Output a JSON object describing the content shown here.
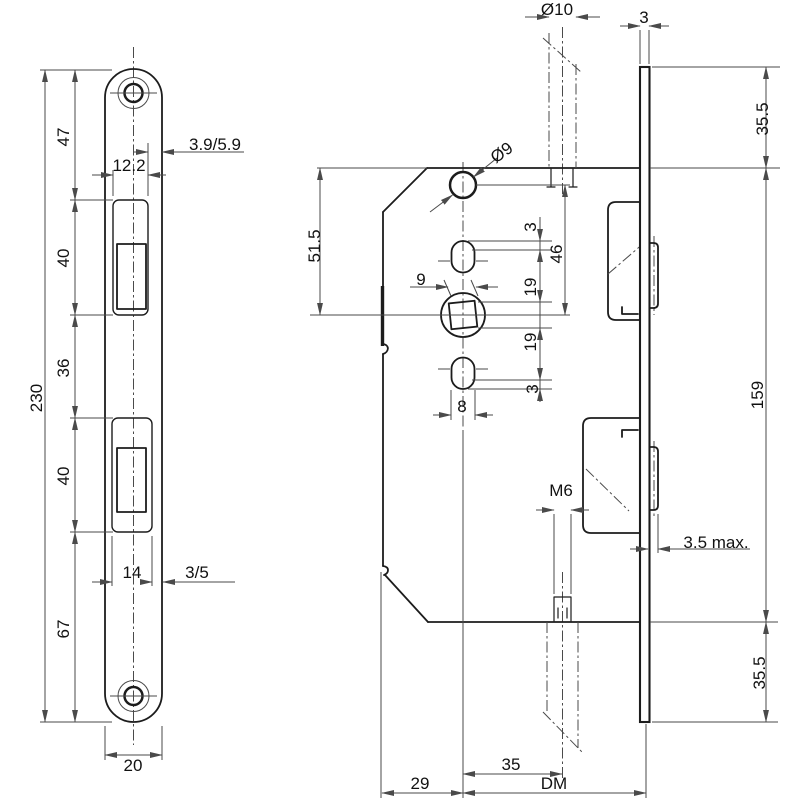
{
  "drawing_title": "mortise-lock-technical-drawing",
  "colors": {
    "ink": "#1c1c1c",
    "dim": "#4a4a4a",
    "bg": "#ffffff"
  },
  "faceplate_front": {
    "total_height": "230",
    "top_section": "47",
    "upper_cutout_height": "40",
    "mid_section": "36",
    "lower_cutout_height": "40",
    "bottom_section": "67",
    "plate_width": "20",
    "upper_cutout_width": "12.2",
    "upper_edge_offset": "3.9/5.9",
    "lower_cutout_width": "14",
    "lower_edge_offset": "3/5"
  },
  "lock_case": {
    "spindle_diameter": "Ø10",
    "top_hole_diameter": "Ø9",
    "edge_to_axis": "51.5",
    "hole_to_axis": "46",
    "upper_slot_elongation": "3",
    "upper_slot_clearance": "19",
    "lower_slot_clearance": "19",
    "lower_slot_elongation": "3",
    "follower_square": "9",
    "slot_width": "8",
    "thread_size": "M6",
    "axis_to_screw": "35",
    "case_back_to_axis": "29",
    "backset": "DM"
  },
  "faceplate_edge": {
    "thickness": "3",
    "upper_length": "35.5",
    "middle_length": "159",
    "lower_length": "35.5",
    "bolt_protrusion": "3.5 max."
  }
}
